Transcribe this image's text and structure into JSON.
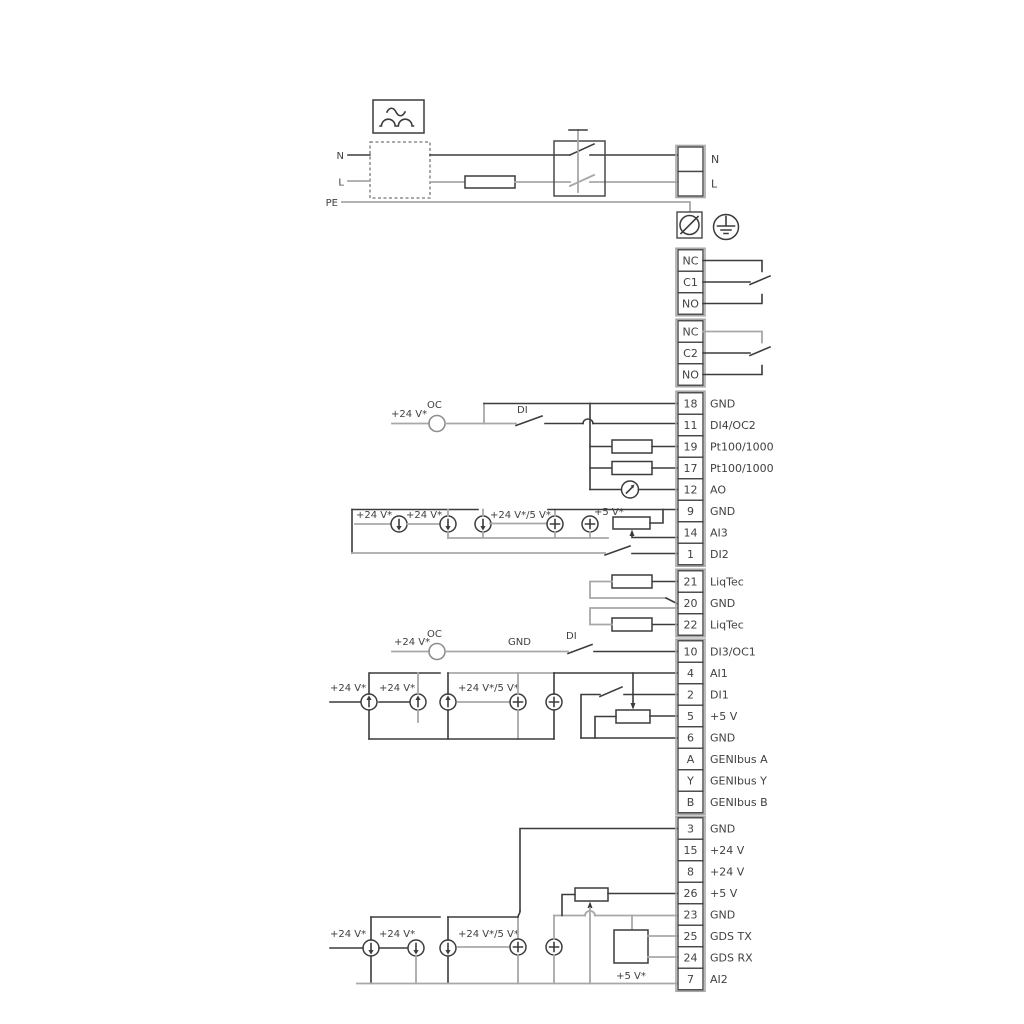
{
  "power": {
    "n_left": "N",
    "l_left": "L",
    "pe_left": "PE",
    "n_right": "N",
    "l_right": "L"
  },
  "relays": {
    "r1": [
      "NC",
      "C1",
      "NO"
    ],
    "r2": [
      "NC",
      "C2",
      "NO"
    ]
  },
  "terminals": {
    "g1": [
      {
        "id": "18",
        "label": "GND"
      },
      {
        "id": "11",
        "label": "DI4/OC2"
      },
      {
        "id": "19",
        "label": "Pt100/1000"
      },
      {
        "id": "17",
        "label": "Pt100/1000"
      },
      {
        "id": "12",
        "label": "AO"
      },
      {
        "id": "9",
        "label": "GND"
      },
      {
        "id": "14",
        "label": "AI3"
      },
      {
        "id": "1",
        "label": "DI2"
      }
    ],
    "g2": [
      {
        "id": "21",
        "label": "LiqTec"
      },
      {
        "id": "20",
        "label": "GND"
      },
      {
        "id": "22",
        "label": "LiqTec"
      }
    ],
    "g3": [
      {
        "id": "10",
        "label": "DI3/OC1"
      },
      {
        "id": "4",
        "label": "AI1"
      },
      {
        "id": "2",
        "label": "DI1"
      },
      {
        "id": "5",
        "label": "+5 V"
      },
      {
        "id": "6",
        "label": "GND"
      },
      {
        "id": "A",
        "label": "GENIbus A"
      },
      {
        "id": "Y",
        "label": "GENIbus Y"
      },
      {
        "id": "B",
        "label": "GENIbus B"
      }
    ],
    "g4": [
      {
        "id": "3",
        "label": "GND"
      },
      {
        "id": "15",
        "label": "+24 V"
      },
      {
        "id": "8",
        "label": "+24 V"
      },
      {
        "id": "26",
        "label": "+5 V"
      },
      {
        "id": "23",
        "label": "GND"
      },
      {
        "id": "25",
        "label": "GDS TX"
      },
      {
        "id": "24",
        "label": "GDS RX"
      },
      {
        "id": "7",
        "label": "AI2"
      }
    ]
  },
  "annotations": {
    "plus24": "+24 V*",
    "plus24or5": "+24 V*/5 V*",
    "plus5star": "+5 V*",
    "oc": "OC",
    "di": "DI",
    "gnd": "GND"
  },
  "symbols": {
    "rectifier": "ac-waveform-box",
    "emc_filter": "dashed-box",
    "fuse": "fuse",
    "mains_switch": "double-pole-switch",
    "pe_terminal": "slashed-circle",
    "earth": "protective-earth",
    "current_source": "circle-with-arrow",
    "resistor": "resistor-box",
    "potentiometer": "potentiometer",
    "analog_output": "gauge-needle-circle",
    "gds_sensor": "sensor-box"
  },
  "colors": {
    "line_dark": "#3c3c3e",
    "line_gray": "#a8a8aa",
    "text": "#414042",
    "cell_border": "#47474a",
    "background": "#ffffff"
  }
}
